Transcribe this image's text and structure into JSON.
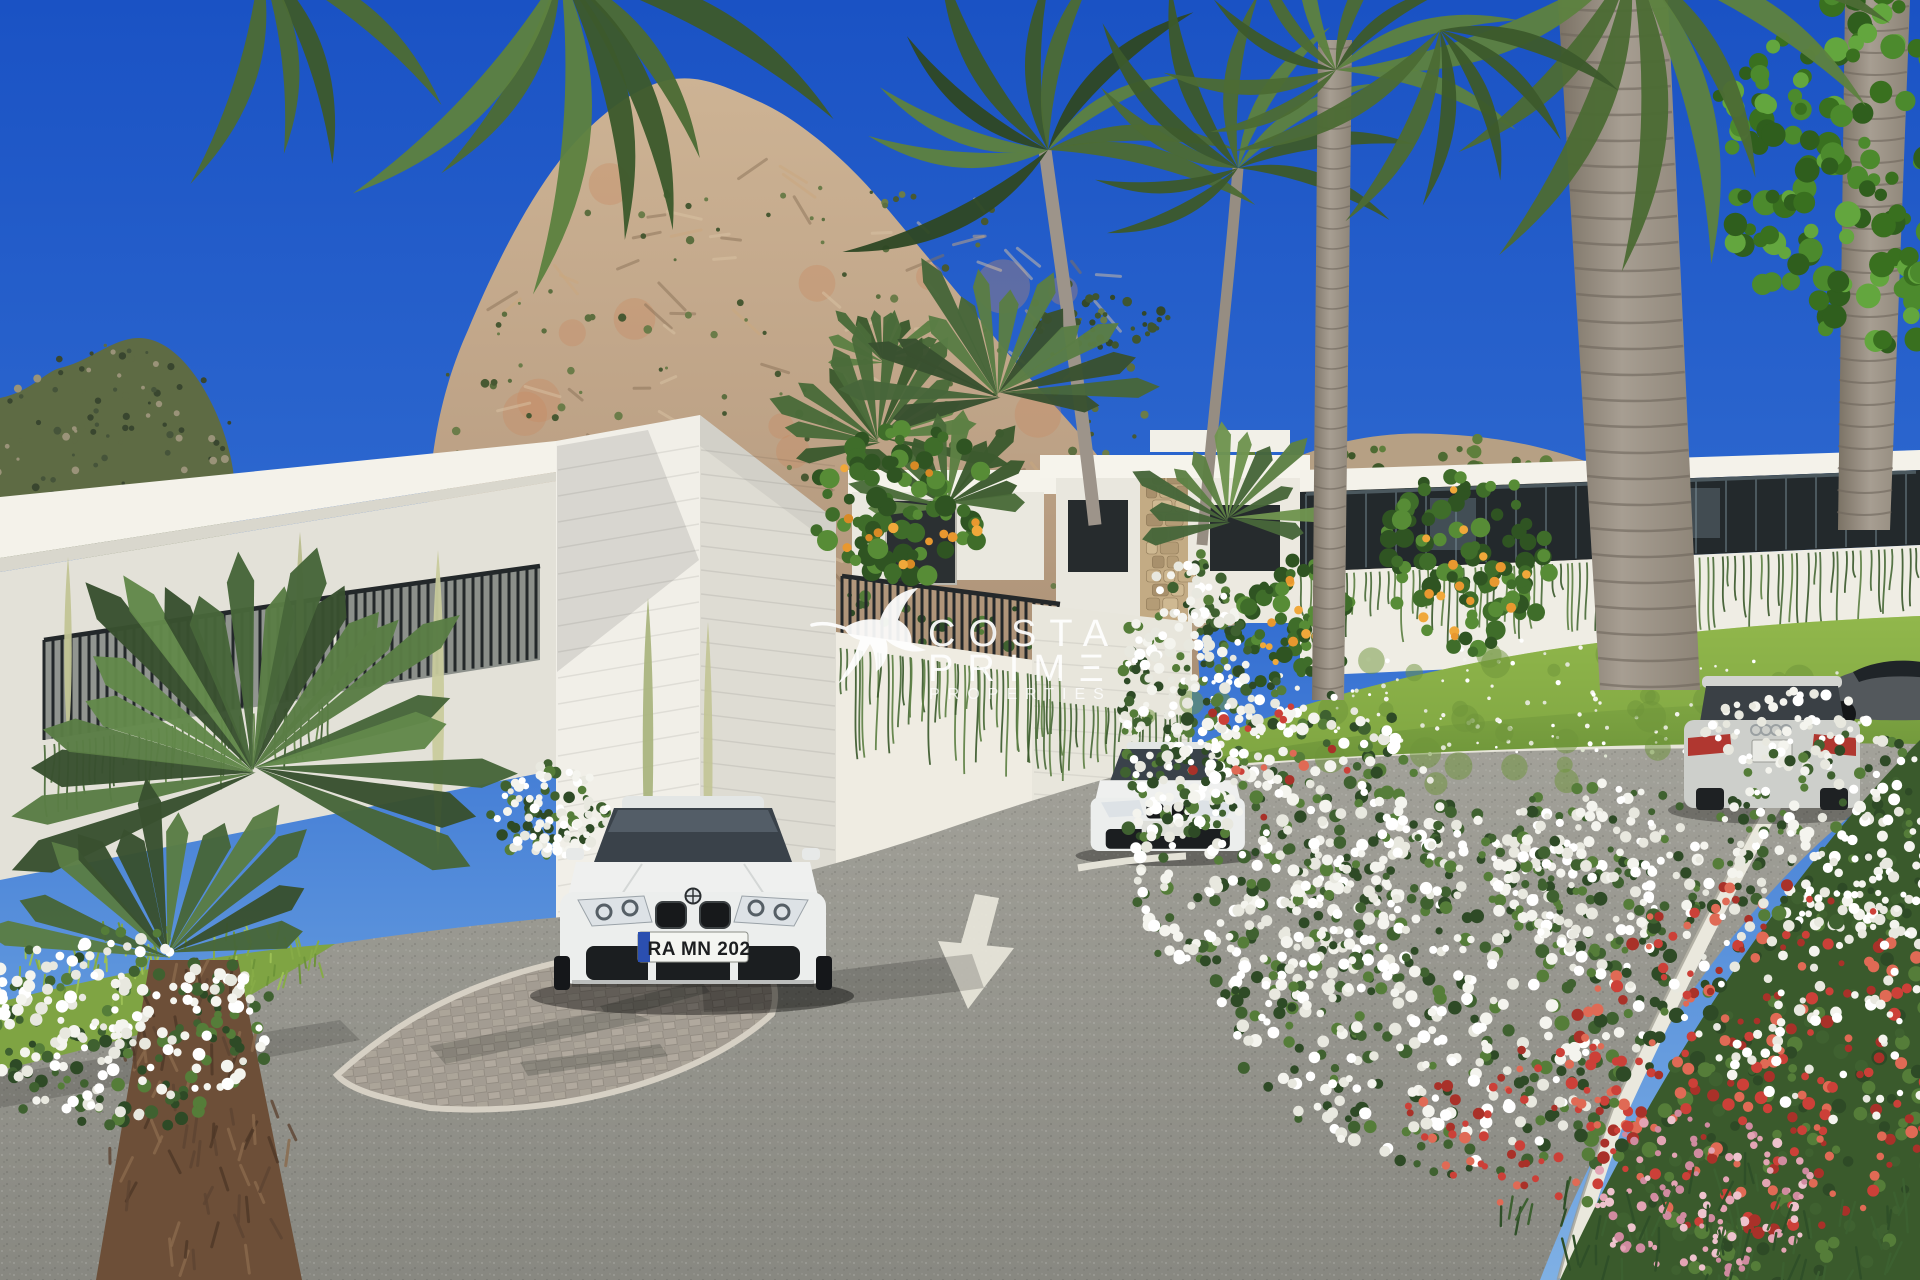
{
  "image": {
    "kind": "photorealistic real-estate render",
    "description": "Modern white hillside villas beneath a large limestone rock crag, palm trees and flowering oleander, a curving asphalt road with a painted white arrow, a white coupe parked on a paver bay, a second white car further up the road, and a silver estate car plus a dark sports car on the right."
  },
  "watermark": {
    "logo": "hummingbird-icon",
    "line1": "COSTA",
    "line2": "PRIME",
    "line2_display": "PRIMΞ",
    "line3": "PROPERTIES",
    "color": "#ffffff"
  },
  "vehicles": {
    "front_car": {
      "description": "white coupe, front view, parked in paver bay",
      "plate": "RA MN 202",
      "plate_eu_band_color": "#2b4fb0"
    },
    "mid_car": {
      "description": "white saloon partially hidden by white flowers"
    },
    "right_car": {
      "description": "silver estate car, rear view, driving up the road"
    },
    "far_right_car": {
      "description": "dark grey sports car parked beyond the flowers"
    }
  },
  "road": {
    "marking": "white arrow painted on asphalt pointing toward viewer"
  },
  "palette": {
    "sky_top": "#1a52c4",
    "sky_horizon": "#7fb0e4",
    "rock": "#c2a686",
    "rock_accent": "#c98a61",
    "villa_white": "#f3f1ea",
    "railing": "#2c3133",
    "foliage": "#4a6b34",
    "grass": "#7ba23f",
    "asphalt": "#90908a",
    "paver": "#a8a199",
    "curb": "#e9e7dd",
    "flower_white": "#f4f4ee",
    "flower_red": "#cc4038",
    "flower_pink": "#e3a4b4",
    "orange_fruit": "#e8982f",
    "trunk_grey": "#a79e92",
    "trunk_brown": "#6d4f38"
  }
}
